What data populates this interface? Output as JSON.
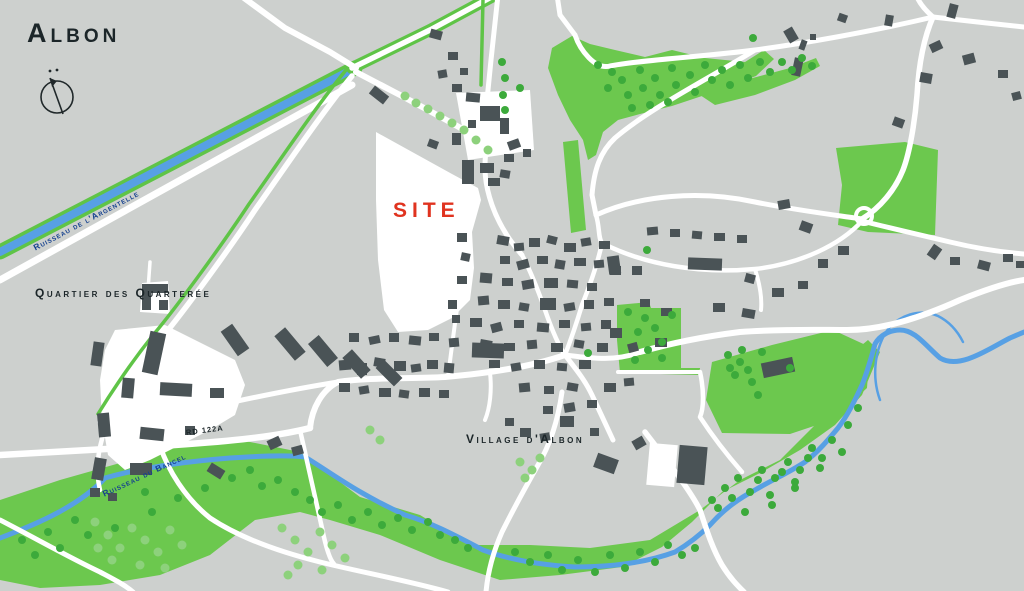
{
  "title": "Albon",
  "labels": {
    "site": "SITE",
    "quartier": "Quartier des Quarterée",
    "village": "Village d'Albon",
    "river_argentelle": "Ruisseau de l'Argentelle",
    "river_bancel": "Ruisseau du Bancel",
    "road_rd122a": "RD 122A"
  },
  "icons": {
    "north_indicator": "compass-north-icon"
  },
  "colors": {
    "background": "#cdd0ce",
    "road": "#ffffff",
    "building": "#4a5356",
    "field_green": "#6cc84e",
    "tree_dark": "#3caa3b",
    "tree_light": "#8dd17c",
    "river_blue": "#57a0e4",
    "road_stripe_green": "#5fc447",
    "label_dark": "#1c2629",
    "label_river_blue": "#15418f",
    "site_red": "#e0331f"
  }
}
